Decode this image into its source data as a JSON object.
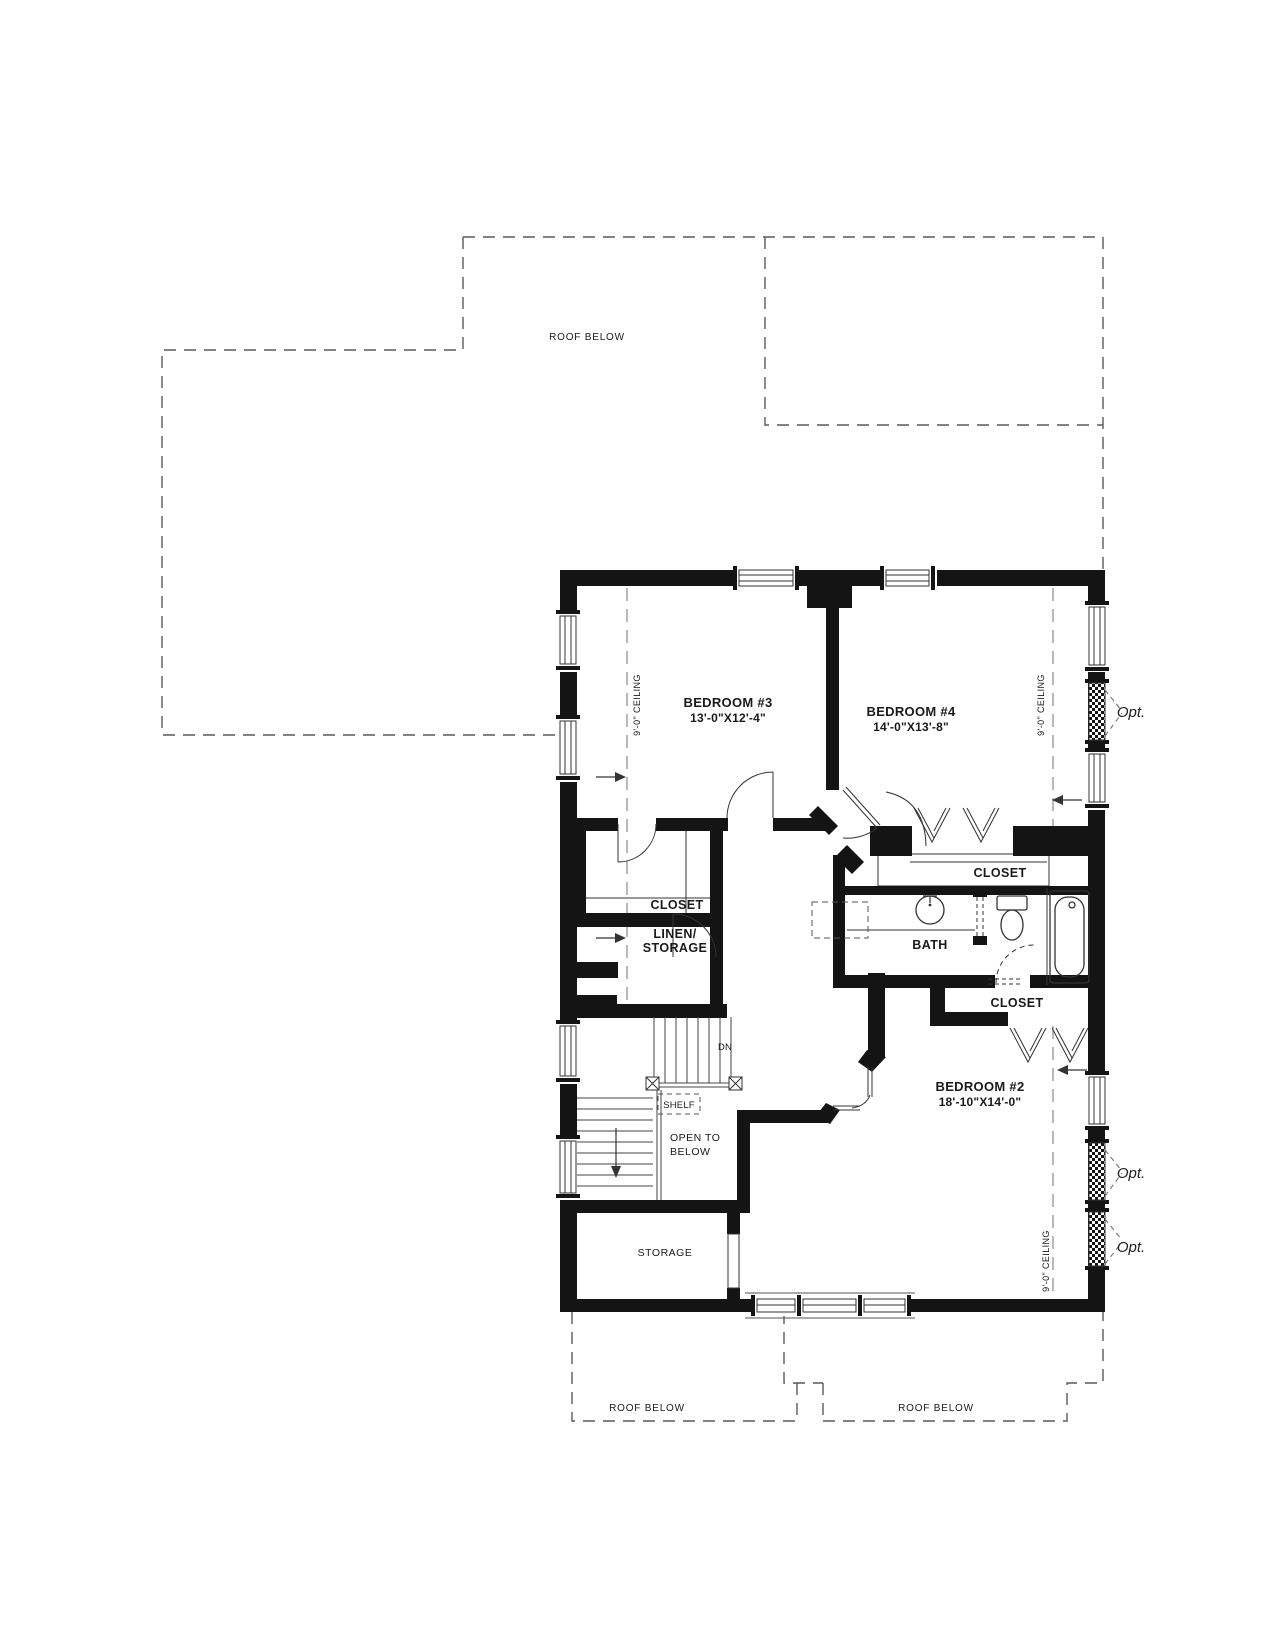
{
  "colors": {
    "wall": "#141414",
    "line": "#333333",
    "roof_dash": "#5a5a5a",
    "ceiling_dash": "#8a8a8a",
    "text": "#1a1a1a",
    "background": "#ffffff"
  },
  "roof": {
    "top": "ROOF BELOW",
    "bottom_left": "ROOF BELOW",
    "bottom_right": "ROOF BELOW"
  },
  "rooms": {
    "bedroom3": {
      "name": "BEDROOM #3",
      "dims": "13'-0\"X12'-4\""
    },
    "bedroom4": {
      "name": "BEDROOM #4",
      "dims": "14'-0\"X13'-8\""
    },
    "bedroom2": {
      "name": "BEDROOM #2",
      "dims": "18'-10\"X14'-0\""
    },
    "hall_closet": "CLOSET",
    "br4_closet": "CLOSET",
    "br2_closet": "CLOSET",
    "linen": {
      "line1": "LINEN/",
      "line2": "STORAGE"
    },
    "bath": "BATH",
    "storage": "STORAGE",
    "open_to_below": {
      "line1": "OPEN TO",
      "line2": "BELOW"
    },
    "shelf": "SHELF"
  },
  "annotations": {
    "dn": "DN",
    "ceiling_left": "9'-0\" CEILING",
    "ceiling_bedroom4": "9'-0\" CEILING",
    "ceiling_bedroom2": "9'-0\" CEILING",
    "opt_window_1": "Opt.",
    "opt_window_2": "Opt.",
    "opt_window_3": "Opt."
  }
}
